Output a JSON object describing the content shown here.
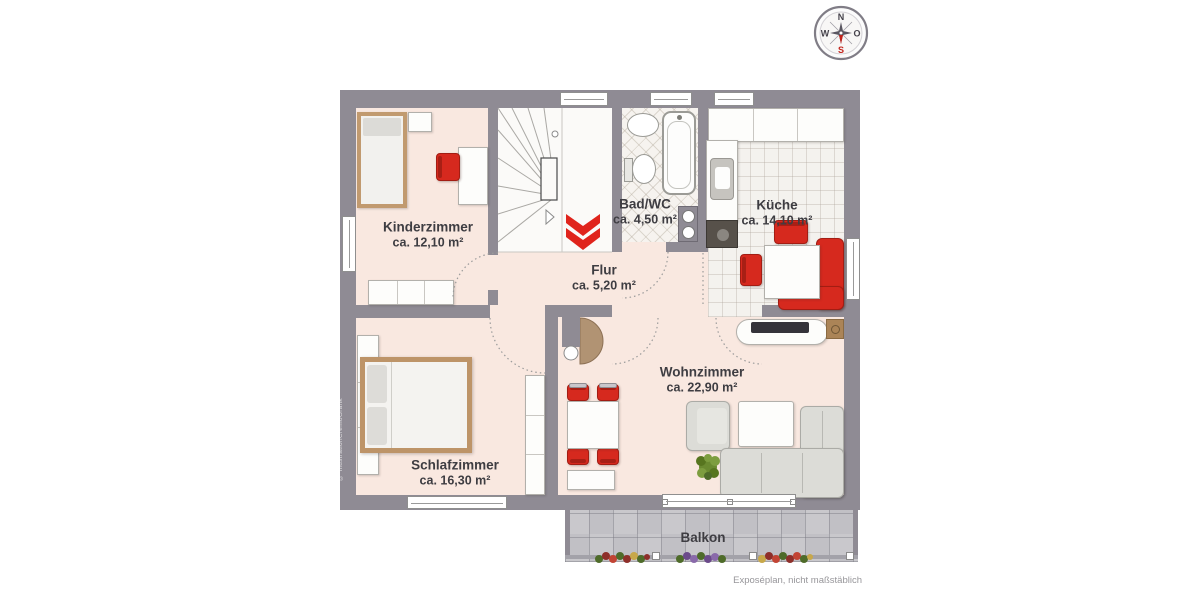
{
  "compass": {
    "north": "N",
    "east": "O",
    "south": "S",
    "west": "W"
  },
  "rooms": {
    "kinderzimmer": {
      "name": "Kinderzimmer",
      "area": "ca. 12,10 m²"
    },
    "bad": {
      "name": "Bad/WC",
      "area": "ca. 4,50 m²"
    },
    "kueche": {
      "name": "Küche",
      "area": "ca. 14,10 m²"
    },
    "flur": {
      "name": "Flur",
      "area": "ca. 5,20 m²"
    },
    "wohnzimmer": {
      "name": "Wohnzimmer",
      "area": "ca. 22,90 m²"
    },
    "schlafzimmer": {
      "name": "Schlafzimmer",
      "area": "ca. 16,30 m²"
    },
    "balkon": {
      "name": "Balkon"
    }
  },
  "footer": {
    "disclaimer": "Exposéplan, nicht maßstäblich"
  },
  "watermark": "© IllustrationCremoGrafik",
  "colors": {
    "wall": "#8f8b94",
    "floor": "#f9e8e0",
    "accent_red": "#d6291e",
    "balcony_tile": "#c7c6ca"
  }
}
